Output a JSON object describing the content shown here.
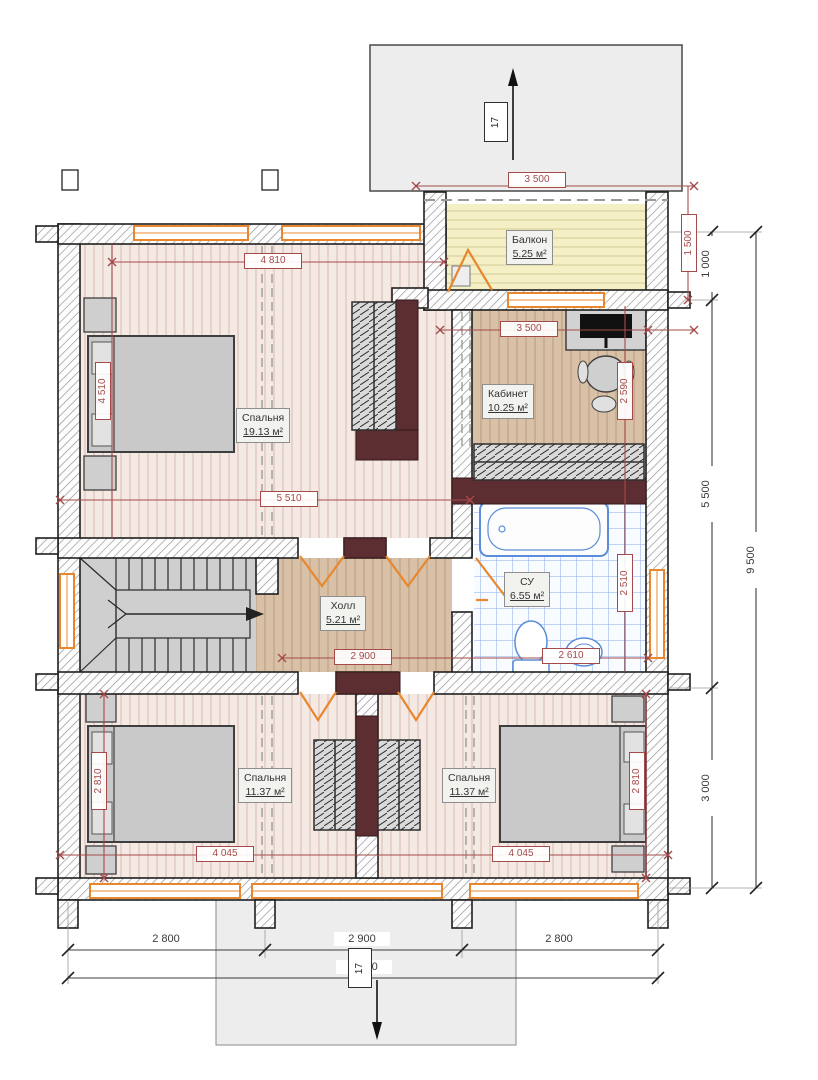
{
  "rooms": {
    "balcony": {
      "name": "Балкон",
      "area": "5.25 м²"
    },
    "office": {
      "name": "Кабинет",
      "area": "10.25 м²"
    },
    "bedroom_top": {
      "name": "Спальня",
      "area": "19.13 м²"
    },
    "hall": {
      "name": "Холл",
      "area": "5.21 м²"
    },
    "bathroom": {
      "name": "СУ",
      "area": "6.55 м²"
    },
    "bedroom_left": {
      "name": "Спальня",
      "area": "11.37 м²"
    },
    "bedroom_right": {
      "name": "Спальня",
      "area": "11.37 м²"
    }
  },
  "dims_red": {
    "balcony_width": "3 500",
    "balcony_depth": "1 500",
    "bedroom_top_width": "4 810",
    "bedroom_top_height": "4 510",
    "bedroom_top_inner_width": "5 510",
    "office_width": "3 500",
    "office_height": "2 590",
    "hall_width": "2 900",
    "bathroom_height": "2 510",
    "bathroom_width": "2 610",
    "bedroom_left_width": "4 045",
    "bedroom_left_height": "2 810",
    "bedroom_right_width": "4 045",
    "bedroom_right_height": "2 810"
  },
  "dims_black": {
    "right_1": "1 000",
    "right_2": "5 500",
    "right_3": "3 000",
    "right_total": "9 500",
    "bottom_1": "2 800",
    "bottom_2": "2 900",
    "bottom_3": "2 800",
    "bottom_total": "8 500"
  },
  "markers": {
    "section_top": "17",
    "section_bottom": "17"
  },
  "colors": {
    "dim_red": "#a54a4a",
    "window_orange": "#e8872e",
    "chimney_dark": "#5c2e31",
    "tile_blue": "#5b8ed6"
  }
}
